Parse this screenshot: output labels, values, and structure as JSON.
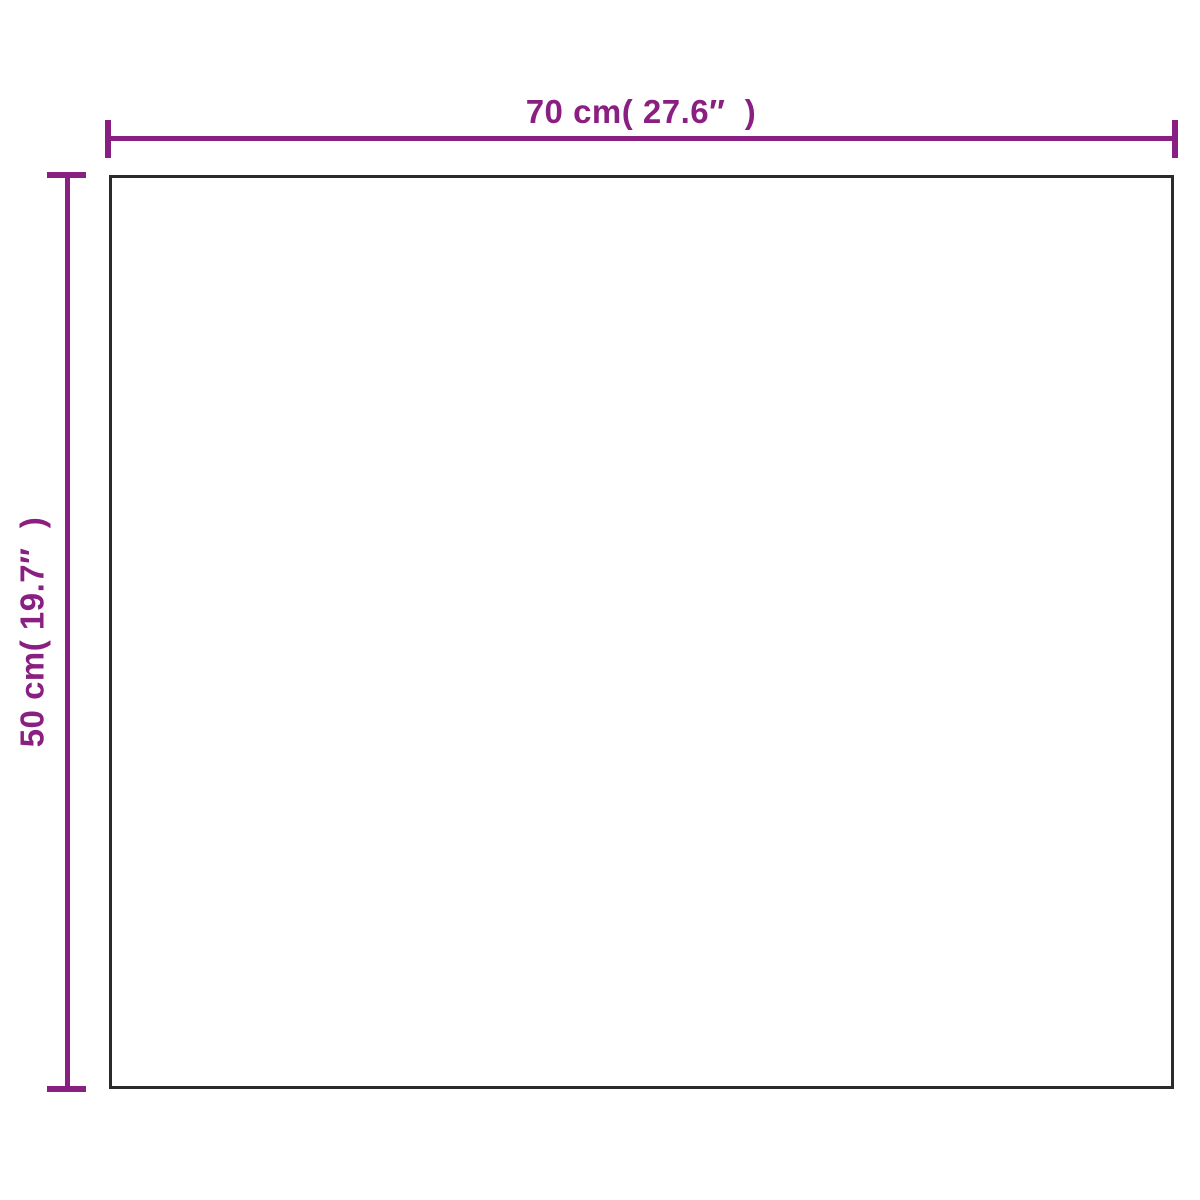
{
  "diagram": {
    "type": "product-dimension-diagram",
    "width_label": "70 cm( 27.6″  )",
    "height_label": "50 cm( 19.7″  )",
    "colors": {
      "dimension": "#8a1f82",
      "outline": "#2b2b2b",
      "background": "#ffffff"
    }
  }
}
